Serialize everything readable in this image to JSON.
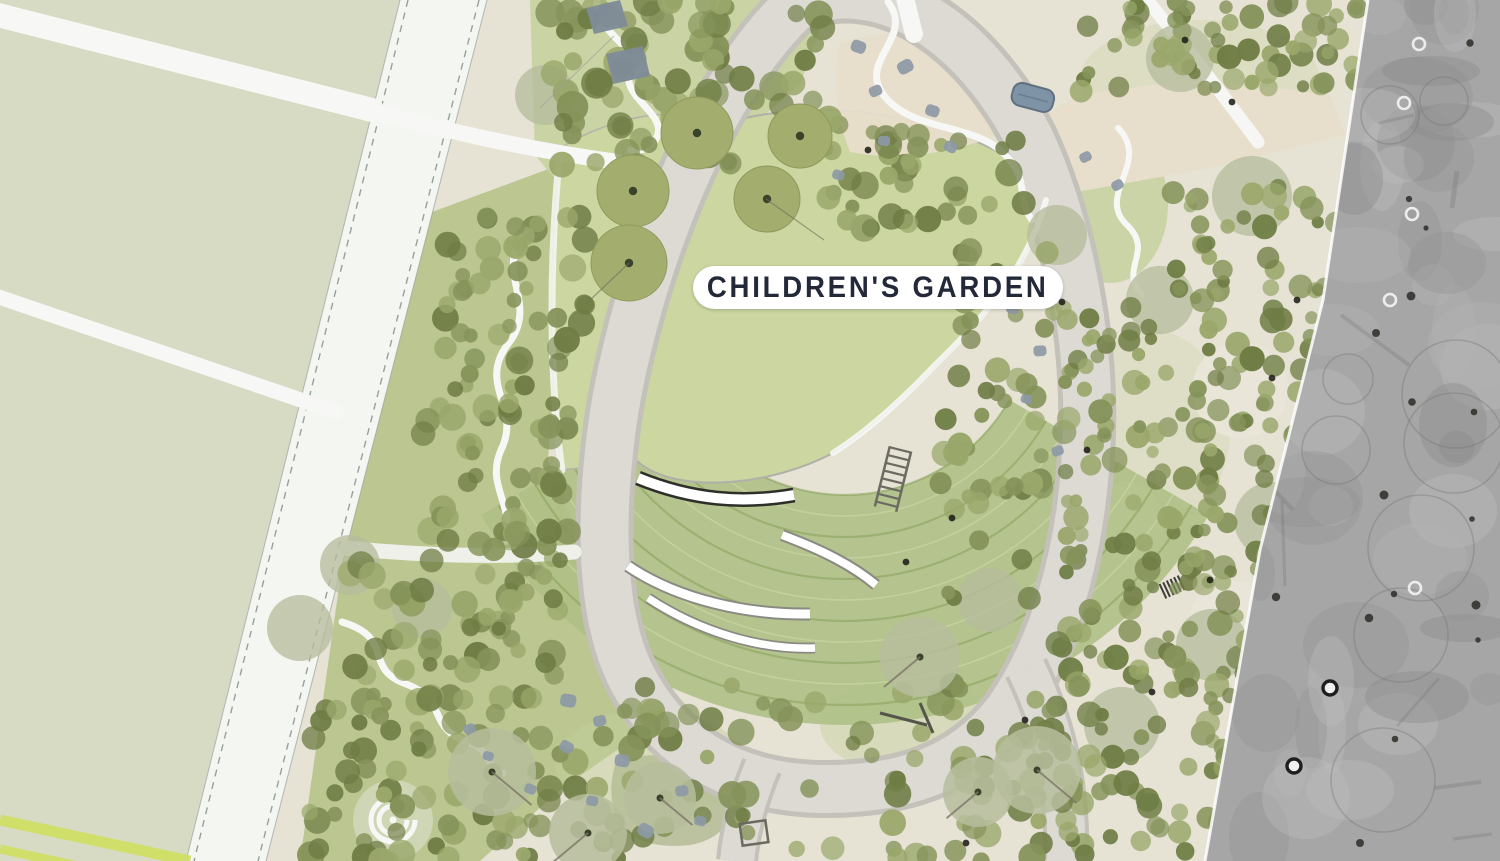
{
  "label": {
    "text": "CHILDREN'S GARDEN"
  },
  "palette": {
    "field": "#d7dbc4",
    "road": "#f4f6f2",
    "road_edge": "#98a09c",
    "garden_ground": "#e6e2d4",
    "plaza_tan": "#e7decb",
    "lawn": "#cbd6a0",
    "grove_bg_1": "#c6d19d",
    "grove_bg_2": "#b8c48c",
    "tree_olive_dark": "#6f7d45",
    "tree_olive": "#85935a",
    "tree_olive_light": "#9aa76b",
    "canopy_sage": "#b6bd9c",
    "lawn_tree": "#a2ad6e",
    "lawn_tree_edge": "#8e9a5d",
    "lawn_tree_dot": "#39422a",
    "ring_path": "#dcdad3",
    "ring_edge": "#c3c1b9",
    "terrace_fill": "#aebf85",
    "terrace_line": "#8ca35e",
    "terrace_line_light": "#cfdba8",
    "bench_white": "#ffffff",
    "bench_outline": "#8a8a82",
    "bench_outline_dark": "#2f2f2a",
    "boulder": "#8d99a6",
    "water_feature": "#7e93a5",
    "water_edge": "#5f7181",
    "sage_patch": "#b7bf99",
    "white_path": "#f7f8f5",
    "photo_gray_1": "#a6a6a6",
    "stripe_lime": "#cfdf6a",
    "label_bg": "#ffffff",
    "label_text": "#232939"
  },
  "scenery": {
    "seed": 11,
    "clusters": [
      {
        "x": 545,
        "y": 0,
        "w": 200,
        "h": 165,
        "n": 55,
        "rmin": 8,
        "rmax": 16
      },
      {
        "x": 700,
        "y": 0,
        "w": 130,
        "h": 110,
        "n": 22,
        "rmin": 8,
        "rmax": 15
      },
      {
        "x": 820,
        "y": 118,
        "w": 210,
        "h": 118,
        "n": 40,
        "rmin": 7,
        "rmax": 14
      },
      {
        "x": 940,
        "y": 250,
        "w": 130,
        "h": 350,
        "n": 55,
        "rmin": 7,
        "rmax": 13
      },
      {
        "x": 1080,
        "y": 0,
        "w": 280,
        "h": 92,
        "n": 62,
        "rmin": 6,
        "rmax": 13
      },
      {
        "x": 1170,
        "y": 185,
        "w": 190,
        "h": 115,
        "n": 45,
        "rmin": 6,
        "rmax": 13
      },
      {
        "x": 1060,
        "y": 300,
        "w": 280,
        "h": 290,
        "n": 150,
        "rmin": 6,
        "rmax": 13
      },
      {
        "x": 1035,
        "y": 590,
        "w": 260,
        "h": 270,
        "n": 125,
        "rmin": 6,
        "rmax": 13
      },
      {
        "x": 445,
        "y": 212,
        "w": 145,
        "h": 175,
        "n": 48,
        "rmin": 7,
        "rmax": 14
      },
      {
        "x": 420,
        "y": 387,
        "w": 150,
        "h": 175,
        "n": 48,
        "rmin": 7,
        "rmax": 14
      },
      {
        "x": 350,
        "y": 560,
        "w": 215,
        "h": 150,
        "n": 58,
        "rmin": 7,
        "rmax": 14
      },
      {
        "x": 300,
        "y": 708,
        "w": 250,
        "h": 153,
        "n": 62,
        "rmin": 7,
        "rmax": 14
      },
      {
        "x": 560,
        "y": 685,
        "w": 480,
        "h": 176,
        "n": 85,
        "rmin": 7,
        "rmax": 14
      }
    ],
    "canopies_under": [
      [
        1180,
        58,
        34
      ],
      [
        1252,
        196,
        40
      ],
      [
        1160,
        300,
        34
      ],
      [
        1272,
        520,
        38
      ],
      [
        1212,
        645,
        36
      ],
      [
        1122,
        725,
        38
      ],
      [
        350,
        565,
        30
      ],
      [
        300,
        628,
        33
      ],
      [
        422,
        608,
        30
      ],
      [
        545,
        95,
        30
      ],
      [
        1057,
        235,
        30
      ],
      [
        990,
        600,
        32
      ]
    ],
    "canopies_top": [
      [
        920,
        657,
        40
      ],
      [
        1037,
        770,
        44
      ],
      [
        978,
        792,
        35
      ],
      [
        492,
        772,
        44
      ],
      [
        588,
        833,
        39
      ],
      [
        660,
        798,
        36
      ]
    ],
    "lawn_trees": [
      [
        697,
        133,
        36
      ],
      [
        800,
        136,
        32
      ],
      [
        767,
        199,
        33
      ],
      [
        633,
        191,
        36
      ],
      [
        629,
        263,
        38
      ]
    ],
    "boulders": [
      [
        858,
        48,
        15
      ],
      [
        876,
        92,
        13
      ],
      [
        906,
        68,
        16
      ],
      [
        932,
        112,
        14
      ],
      [
        950,
        148,
        13
      ],
      [
        884,
        142,
        12
      ],
      [
        838,
        176,
        12
      ],
      [
        568,
        702,
        16
      ],
      [
        600,
        722,
        13
      ],
      [
        566,
        748,
        14
      ],
      [
        622,
        762,
        15
      ],
      [
        682,
        792,
        13
      ],
      [
        592,
        802,
        12
      ],
      [
        645,
        832,
        16
      ],
      [
        700,
        822,
        12
      ],
      [
        470,
        730,
        12
      ],
      [
        488,
        757,
        11
      ],
      [
        530,
        790,
        12
      ],
      [
        1012,
        310,
        12
      ],
      [
        1040,
        352,
        13
      ],
      [
        1026,
        400,
        11
      ],
      [
        1058,
        452,
        12
      ],
      [
        1086,
        158,
        12
      ],
      [
        1118,
        186,
        12
      ]
    ],
    "band_dots": [
      [
        1185,
        40
      ],
      [
        1232,
        102
      ],
      [
        1297,
        300
      ],
      [
        1272,
        378
      ],
      [
        1210,
        580
      ],
      [
        1152,
        692
      ],
      [
        1062,
        302
      ],
      [
        1087,
        450
      ],
      [
        1025,
        720
      ],
      [
        966,
        843
      ],
      [
        952,
        518
      ],
      [
        906,
        562
      ],
      [
        868,
        150
      ]
    ],
    "terrace": {
      "cx": 845,
      "cy": 305,
      "r0": 190,
      "r1": 420,
      "step": 21,
      "a0": 150,
      "a1": 30
    },
    "photo": {
      "edge_pts": [
        [
          0,
          1368
        ],
        [
          300,
          1323
        ],
        [
          550,
          1260
        ],
        [
          861,
          1205
        ]
      ],
      "blobs": 48,
      "rings": 9,
      "dots": 16,
      "streaks": 8,
      "white_rings": [
        [
          1419,
          44
        ],
        [
          1404,
          103
        ],
        [
          1390,
          300
        ],
        [
          1412,
          214
        ],
        [
          1415,
          588
        ],
        [
          1316,
          16
        ]
      ],
      "dark_rings": [
        [
          1330,
          688
        ],
        [
          1294,
          766
        ]
      ]
    }
  }
}
